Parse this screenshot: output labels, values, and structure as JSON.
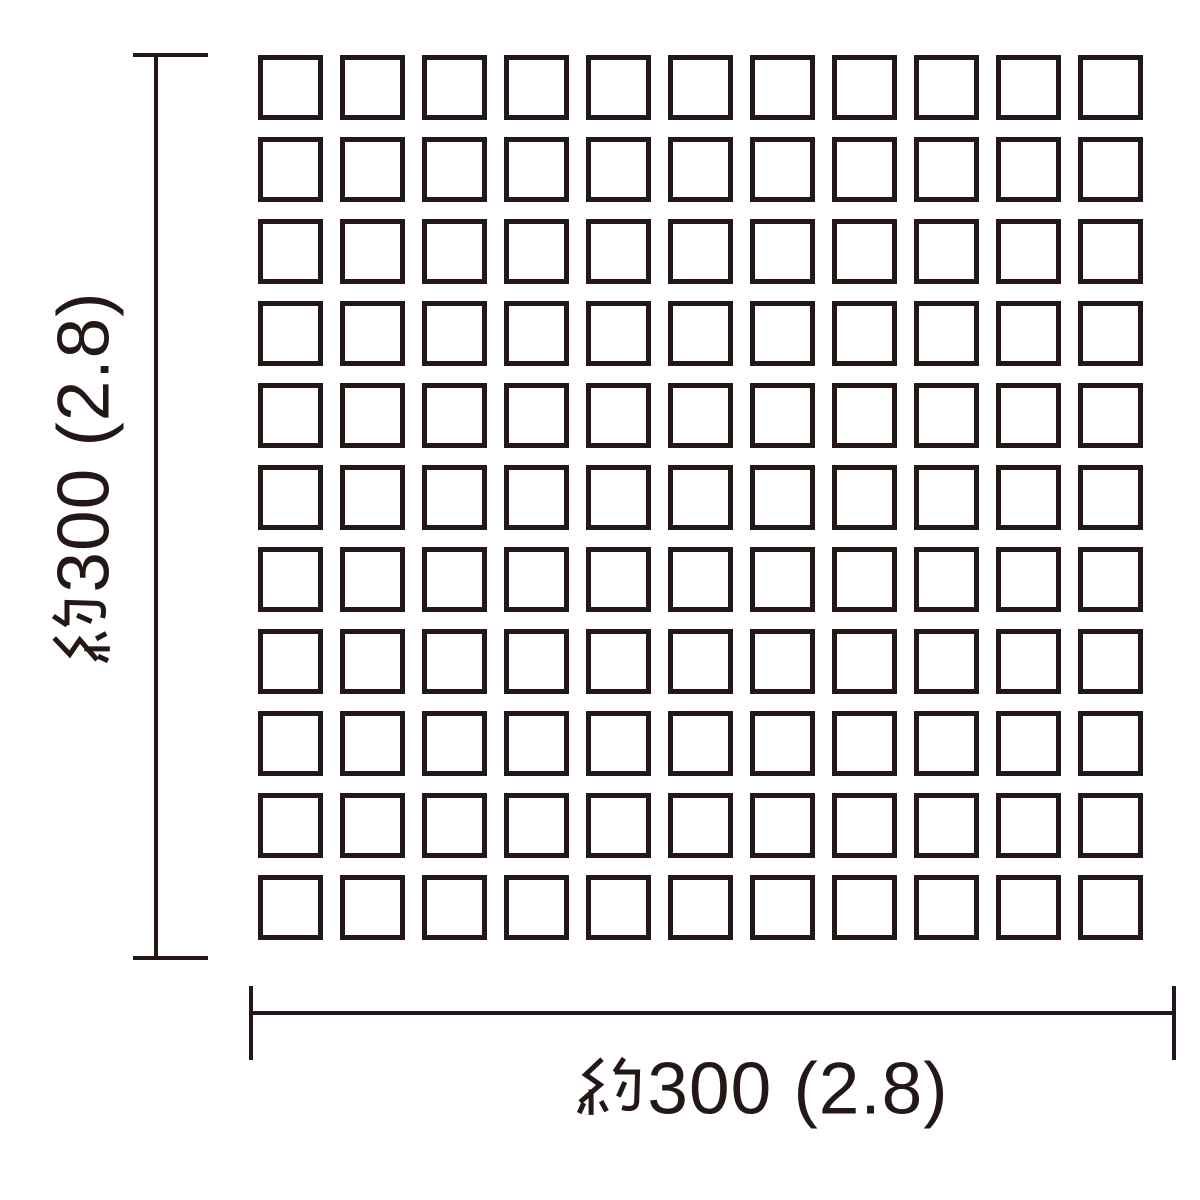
{
  "diagram": {
    "title": "mosaic-tile-sheet-dimension-diagram",
    "background_color": "#ffffff",
    "line_color": "#231815",
    "grid": {
      "rows": 11,
      "columns": 11,
      "tile_count": 121
    },
    "dimensions": {
      "height": {
        "label": "約300 (2.8)",
        "kanji_prefix": "約",
        "value_text": "300 (2.8)",
        "orientation": "vertical"
      },
      "width": {
        "label": "約300 (2.8)",
        "kanji_prefix": "約",
        "value_text": "300 (2.8)",
        "orientation": "horizontal"
      }
    }
  }
}
